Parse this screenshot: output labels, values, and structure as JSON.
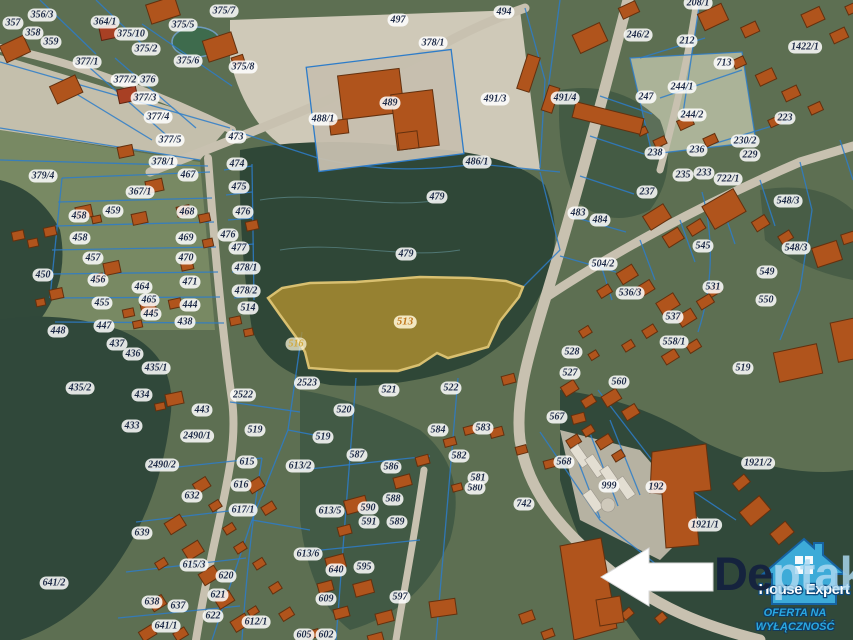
{
  "highlight": {
    "parcel": "513",
    "fill": "#b3922f"
  },
  "colors": {
    "parcel_line": "#2d7cc9",
    "building": "#b0541c",
    "highlight_fill": "#b3922f",
    "label_text": "#1c2946",
    "logo_blue": "#3eb4e6"
  },
  "watermark": {
    "prefix": "De",
    "suffix": "ptak"
  },
  "logo": {
    "brand": "House Expert",
    "tagline_line1": "OFERTA NA",
    "tagline_line2": "WYŁĄCZNOŚĆ"
  },
  "map": {
    "labels": [
      {
        "t": "356/3",
        "x": 42,
        "y": 15
      },
      {
        "t": "364/1",
        "x": 105,
        "y": 22
      },
      {
        "t": "357",
        "x": 13,
        "y": 23
      },
      {
        "t": "358",
        "x": 33,
        "y": 33
      },
      {
        "t": "359",
        "x": 51,
        "y": 42
      },
      {
        "t": "375/10",
        "x": 131,
        "y": 34
      },
      {
        "t": "375/2",
        "x": 146,
        "y": 49
      },
      {
        "t": "375/5",
        "x": 183,
        "y": 25
      },
      {
        "t": "375/7",
        "x": 224,
        "y": 11
      },
      {
        "t": "375/6",
        "x": 188,
        "y": 61
      },
      {
        "t": "375/8",
        "x": 243,
        "y": 67
      },
      {
        "t": "377/1",
        "x": 87,
        "y": 62
      },
      {
        "t": "377/2",
        "x": 125,
        "y": 80
      },
      {
        "t": "376",
        "x": 148,
        "y": 80
      },
      {
        "t": "377/3",
        "x": 145,
        "y": 98
      },
      {
        "t": "377/4",
        "x": 158,
        "y": 117
      },
      {
        "t": "377/5",
        "x": 170,
        "y": 140
      },
      {
        "t": "473",
        "x": 236,
        "y": 137
      },
      {
        "t": "379/4",
        "x": 43,
        "y": 176
      },
      {
        "t": "378/1",
        "x": 163,
        "y": 162
      },
      {
        "t": "467",
        "x": 188,
        "y": 175
      },
      {
        "t": "474",
        "x": 237,
        "y": 164
      },
      {
        "t": "475",
        "x": 239,
        "y": 187
      },
      {
        "t": "476",
        "x": 243,
        "y": 212
      },
      {
        "t": "476",
        "x": 228,
        "y": 235
      },
      {
        "t": "477",
        "x": 239,
        "y": 248
      },
      {
        "t": "478/1",
        "x": 246,
        "y": 268
      },
      {
        "t": "478/2",
        "x": 246,
        "y": 291
      },
      {
        "t": "514",
        "x": 248,
        "y": 308
      },
      {
        "t": "458",
        "x": 79,
        "y": 216
      },
      {
        "t": "459",
        "x": 113,
        "y": 211
      },
      {
        "t": "367/1",
        "x": 140,
        "y": 192
      },
      {
        "t": "468",
        "x": 187,
        "y": 212
      },
      {
        "t": "458",
        "x": 80,
        "y": 238
      },
      {
        "t": "457",
        "x": 93,
        "y": 258
      },
      {
        "t": "469",
        "x": 186,
        "y": 238
      },
      {
        "t": "450",
        "x": 43,
        "y": 275
      },
      {
        "t": "456",
        "x": 98,
        "y": 280
      },
      {
        "t": "455",
        "x": 102,
        "y": 303
      },
      {
        "t": "464",
        "x": 142,
        "y": 287
      },
      {
        "t": "465",
        "x": 149,
        "y": 300
      },
      {
        "t": "470",
        "x": 186,
        "y": 258
      },
      {
        "t": "471",
        "x": 190,
        "y": 282
      },
      {
        "t": "445",
        "x": 151,
        "y": 314
      },
      {
        "t": "444",
        "x": 190,
        "y": 305
      },
      {
        "t": "438",
        "x": 185,
        "y": 322
      },
      {
        "t": "447",
        "x": 104,
        "y": 326
      },
      {
        "t": "448",
        "x": 58,
        "y": 331
      },
      {
        "t": "437",
        "x": 117,
        "y": 344
      },
      {
        "t": "436",
        "x": 133,
        "y": 354
      },
      {
        "t": "435/1",
        "x": 156,
        "y": 368
      },
      {
        "t": "435/2",
        "x": 80,
        "y": 388
      },
      {
        "t": "434",
        "x": 142,
        "y": 395
      },
      {
        "t": "433",
        "x": 132,
        "y": 426
      },
      {
        "t": "443",
        "x": 202,
        "y": 410
      },
      {
        "t": "2522",
        "x": 243,
        "y": 395
      },
      {
        "t": "2490/1",
        "x": 197,
        "y": 436
      },
      {
        "t": "2490/2",
        "x": 162,
        "y": 465
      },
      {
        "t": "519",
        "x": 255,
        "y": 430
      },
      {
        "t": "615",
        "x": 247,
        "y": 462
      },
      {
        "t": "616",
        "x": 241,
        "y": 485
      },
      {
        "t": "617/1",
        "x": 243,
        "y": 510
      },
      {
        "t": "632",
        "x": 192,
        "y": 496
      },
      {
        "t": "639",
        "x": 142,
        "y": 533
      },
      {
        "t": "641/2",
        "x": 54,
        "y": 583
      },
      {
        "t": "615/3",
        "x": 194,
        "y": 565
      },
      {
        "t": "620",
        "x": 226,
        "y": 576
      },
      {
        "t": "621",
        "x": 218,
        "y": 595
      },
      {
        "t": "637",
        "x": 178,
        "y": 606
      },
      {
        "t": "638",
        "x": 152,
        "y": 602
      },
      {
        "t": "622",
        "x": 213,
        "y": 616
      },
      {
        "t": "641/1",
        "x": 166,
        "y": 626
      },
      {
        "t": "612/1",
        "x": 256,
        "y": 622
      },
      {
        "t": "497",
        "x": 398,
        "y": 20
      },
      {
        "t": "378/1",
        "x": 433,
        "y": 43
      },
      {
        "t": "488/1",
        "x": 323,
        "y": 119
      },
      {
        "t": "489",
        "x": 390,
        "y": 103
      },
      {
        "t": "486/1",
        "x": 477,
        "y": 162
      },
      {
        "t": "479",
        "x": 437,
        "y": 197
      },
      {
        "t": "479",
        "x": 406,
        "y": 254
      },
      {
        "t": "494",
        "x": 504,
        "y": 12
      },
      {
        "t": "491/3",
        "x": 495,
        "y": 99
      },
      {
        "t": "491/4",
        "x": 565,
        "y": 98
      },
      {
        "t": "513",
        "x": 405,
        "y": 322,
        "c": "hl"
      },
      {
        "t": "516",
        "x": 296,
        "y": 344,
        "c": "hl2"
      },
      {
        "t": "2523",
        "x": 307,
        "y": 383
      },
      {
        "t": "521",
        "x": 389,
        "y": 390
      },
      {
        "t": "522",
        "x": 451,
        "y": 388
      },
      {
        "t": "520",
        "x": 344,
        "y": 410
      },
      {
        "t": "519",
        "x": 323,
        "y": 437
      },
      {
        "t": "587",
        "x": 357,
        "y": 455
      },
      {
        "t": "586",
        "x": 391,
        "y": 467
      },
      {
        "t": "613/2",
        "x": 300,
        "y": 466
      },
      {
        "t": "613/5",
        "x": 330,
        "y": 511
      },
      {
        "t": "613/6",
        "x": 308,
        "y": 554
      },
      {
        "t": "640",
        "x": 336,
        "y": 570
      },
      {
        "t": "595",
        "x": 364,
        "y": 567
      },
      {
        "t": "609",
        "x": 326,
        "y": 599
      },
      {
        "t": "597",
        "x": 400,
        "y": 597
      },
      {
        "t": "605",
        "x": 304,
        "y": 635
      },
      {
        "t": "602",
        "x": 326,
        "y": 635
      },
      {
        "t": "588",
        "x": 393,
        "y": 499
      },
      {
        "t": "589",
        "x": 397,
        "y": 522
      },
      {
        "t": "590",
        "x": 368,
        "y": 508
      },
      {
        "t": "591",
        "x": 369,
        "y": 522
      },
      {
        "t": "580",
        "x": 475,
        "y": 488
      },
      {
        "t": "581",
        "x": 478,
        "y": 478
      },
      {
        "t": "582",
        "x": 459,
        "y": 456
      },
      {
        "t": "583",
        "x": 483,
        "y": 428
      },
      {
        "t": "584",
        "x": 438,
        "y": 430
      },
      {
        "t": "742",
        "x": 524,
        "y": 504
      },
      {
        "t": "208/1",
        "x": 698,
        "y": 3
      },
      {
        "t": "246/2",
        "x": 638,
        "y": 35
      },
      {
        "t": "212",
        "x": 687,
        "y": 41
      },
      {
        "t": "713",
        "x": 724,
        "y": 63
      },
      {
        "t": "1422/1",
        "x": 805,
        "y": 47
      },
      {
        "t": "244/1",
        "x": 682,
        "y": 87
      },
      {
        "t": "247",
        "x": 646,
        "y": 97
      },
      {
        "t": "244/2",
        "x": 692,
        "y": 115
      },
      {
        "t": "238",
        "x": 655,
        "y": 153
      },
      {
        "t": "236",
        "x": 697,
        "y": 150
      },
      {
        "t": "230/2",
        "x": 745,
        "y": 141
      },
      {
        "t": "229",
        "x": 750,
        "y": 155
      },
      {
        "t": "223",
        "x": 785,
        "y": 118
      },
      {
        "t": "235",
        "x": 683,
        "y": 175
      },
      {
        "t": "233",
        "x": 704,
        "y": 173
      },
      {
        "t": "722/1",
        "x": 728,
        "y": 179
      },
      {
        "t": "237",
        "x": 647,
        "y": 192
      },
      {
        "t": "548/3",
        "x": 788,
        "y": 201
      },
      {
        "t": "548/3",
        "x": 796,
        "y": 248
      },
      {
        "t": "483",
        "x": 578,
        "y": 213
      },
      {
        "t": "484",
        "x": 600,
        "y": 220
      },
      {
        "t": "545",
        "x": 703,
        "y": 246
      },
      {
        "t": "549",
        "x": 767,
        "y": 272
      },
      {
        "t": "550",
        "x": 766,
        "y": 300
      },
      {
        "t": "504/2",
        "x": 603,
        "y": 264
      },
      {
        "t": "536/3",
        "x": 630,
        "y": 293
      },
      {
        "t": "531",
        "x": 713,
        "y": 287
      },
      {
        "t": "537",
        "x": 673,
        "y": 317
      },
      {
        "t": "558/1",
        "x": 674,
        "y": 342
      },
      {
        "t": "528",
        "x": 572,
        "y": 352
      },
      {
        "t": "527",
        "x": 570,
        "y": 373
      },
      {
        "t": "560",
        "x": 619,
        "y": 382
      },
      {
        "t": "519",
        "x": 743,
        "y": 368
      },
      {
        "t": "1921/2",
        "x": 758,
        "y": 463
      },
      {
        "t": "999",
        "x": 609,
        "y": 486
      },
      {
        "t": "192",
        "x": 656,
        "y": 487
      },
      {
        "t": "1921/1",
        "x": 705,
        "y": 525
      },
      {
        "t": "568",
        "x": 564,
        "y": 462
      },
      {
        "t": "567",
        "x": 557,
        "y": 417
      }
    ]
  }
}
